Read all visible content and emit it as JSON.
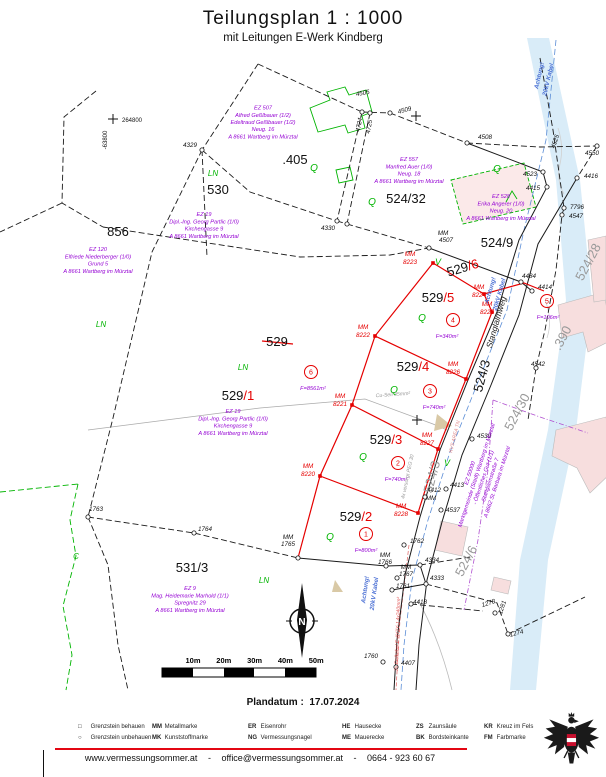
{
  "title": "Teilungsplan  1 : 1000",
  "subtitle": "mit Leitungen E-Werk Kindberg",
  "plandatum_label": "Plandatum :",
  "plandatum_value": "17.07.2024",
  "footer": {
    "website": "www.vermessungsommer.at",
    "sep": "-",
    "email": "office@vermessungsommer.at",
    "phone": "0664 - 923 60 67"
  },
  "legend": {
    "columns_x": [
      78,
      152,
      248,
      342,
      416,
      484
    ],
    "rows_y": [
      724,
      735
    ],
    "row1": [
      {
        "abbr": "□",
        "label": "Grenzstein behauen"
      },
      {
        "abbr": "MM",
        "label": "Metallmarke"
      },
      {
        "abbr": "ER",
        "label": "Eisenrohr"
      },
      {
        "abbr": "HE",
        "label": "Hausecke"
      },
      {
        "abbr": "ZS",
        "label": "Zaunsäule"
      },
      {
        "abbr": "KR",
        "label": "Kreuz im Fels"
      }
    ],
    "row2": [
      {
        "abbr": "○",
        "label": "Grenzstein unbehauen"
      },
      {
        "abbr": "MK",
        "label": "Kunststoffmarke"
      },
      {
        "abbr": "NG",
        "label": "Vermessungsnagel"
      },
      {
        "abbr": "ME",
        "label": "Mauerecke"
      },
      {
        "abbr": "BK",
        "label": "Bordsteinkante"
      },
      {
        "abbr": "FM",
        "label": "Farbmarke"
      }
    ]
  },
  "colors": {
    "new_boundary_red": "#e50000",
    "owner_purple": "#9400d3",
    "landuse_green": "#00b400",
    "cable_blue": "#4a6fd4",
    "stream_blue": "#d9ecf8",
    "building_pink": "#f7dede",
    "separator_red": "#e30613"
  },
  "map": {
    "scalebar": [
      "10m",
      "20m",
      "30m",
      "40m",
      "50m"
    ],
    "north": "N",
    "coordinate_cross": {
      "east": "264800",
      "north": "-63800"
    },
    "markers": [
      [
        202,
        150
      ],
      [
        362,
        112
      ],
      [
        370,
        113
      ],
      [
        390,
        113
      ],
      [
        467,
        143
      ],
      [
        543,
        172
      ],
      [
        547,
        187
      ],
      [
        597,
        146
      ],
      [
        577,
        178
      ],
      [
        564,
        208
      ],
      [
        562,
        215
      ],
      [
        536,
        368
      ],
      [
        337,
        221
      ],
      [
        347,
        224
      ],
      [
        429,
        248
      ],
      [
        521,
        282
      ],
      [
        532,
        291
      ],
      [
        472,
        439
      ],
      [
        446,
        489
      ],
      [
        425,
        497
      ],
      [
        441,
        510
      ],
      [
        404,
        545
      ],
      [
        420,
        565
      ],
      [
        426,
        584
      ],
      [
        386,
        566
      ],
      [
        397,
        578
      ],
      [
        392,
        590
      ],
      [
        411,
        604
      ],
      [
        495,
        613
      ],
      [
        508,
        634
      ],
      [
        396,
        667
      ],
      [
        383,
        662
      ],
      [
        88,
        517
      ],
      [
        194,
        533
      ],
      [
        298,
        558
      ]
    ],
    "red_markers": [
      [
        433,
        263
      ],
      [
        375,
        336
      ],
      [
        352,
        405
      ],
      [
        320,
        476
      ],
      [
        484,
        294
      ],
      [
        492,
        312
      ],
      [
        466,
        379
      ],
      [
        438,
        449
      ],
      [
        418,
        513
      ]
    ],
    "points": [
      {
        "t": "4329",
        "x": 190,
        "y": 147
      },
      {
        "t": "4505",
        "x": 363,
        "y": 95,
        "r": -10
      },
      {
        "t": "4509",
        "x": 405,
        "y": 112,
        "r": -15
      },
      {
        "t": "4724",
        "x": 361,
        "y": 125,
        "r": -80
      },
      {
        "t": "4725",
        "x": 371,
        "y": 127,
        "r": -80
      },
      {
        "t": "4330",
        "x": 328,
        "y": 230
      },
      {
        "t": "4508",
        "x": 485,
        "y": 139
      },
      {
        "t": "4523",
        "x": 530,
        "y": 176
      },
      {
        "t": "4415",
        "x": 533,
        "y": 190
      },
      {
        "t": "4550",
        "x": 592,
        "y": 155
      },
      {
        "t": "4416",
        "x": 591,
        "y": 178
      },
      {
        "t": "4525",
        "x": 557,
        "y": 142,
        "r": -72
      },
      {
        "t": "7796",
        "x": 577,
        "y": 209
      },
      {
        "t": "4547",
        "x": 576,
        "y": 218
      },
      {
        "t": "MM",
        "x": 443,
        "y": 235
      },
      {
        "t": "4507",
        "x": 446,
        "y": 242
      },
      {
        "t": "4484",
        "x": 529,
        "y": 278
      },
      {
        "t": "4414",
        "x": 545,
        "y": 289
      },
      {
        "t": "4542",
        "x": 538,
        "y": 366
      },
      {
        "t": "4539",
        "x": 484,
        "y": 438
      },
      {
        "t": "4413",
        "x": 457,
        "y": 487
      },
      {
        "t": "4412",
        "x": 434,
        "y": 492
      },
      {
        "t": "MM",
        "x": 431,
        "y": 500
      },
      {
        "t": "4537",
        "x": 453,
        "y": 512
      },
      {
        "t": "1762",
        "x": 417,
        "y": 543
      },
      {
        "t": "4334",
        "x": 432,
        "y": 562
      },
      {
        "t": "4333",
        "x": 437,
        "y": 580
      },
      {
        "t": "MM",
        "x": 385,
        "y": 557
      },
      {
        "t": "1766",
        "x": 385,
        "y": 564
      },
      {
        "t": "MM",
        "x": 406,
        "y": 569
      },
      {
        "t": "1767",
        "x": 406,
        "y": 576
      },
      {
        "t": "1761",
        "x": 403,
        "y": 588
      },
      {
        "t": "4418",
        "x": 420,
        "y": 604
      },
      {
        "t": "1278",
        "x": 489,
        "y": 605,
        "r": -18
      },
      {
        "t": "1281",
        "x": 504,
        "y": 608,
        "r": -72
      },
      {
        "t": "1274",
        "x": 517,
        "y": 635,
        "r": -15
      },
      {
        "t": "4407",
        "x": 408,
        "y": 665
      },
      {
        "t": "1760",
        "x": 371,
        "y": 658
      },
      {
        "t": "1763",
        "x": 96,
        "y": 511
      },
      {
        "t": "1764",
        "x": 205,
        "y": 531
      },
      {
        "t": "MM",
        "x": 288,
        "y": 539
      },
      {
        "t": "1765",
        "x": 288,
        "y": 546
      },
      {
        "t": "MM",
        "x": 410,
        "y": 256,
        "c": "r"
      },
      {
        "t": "8223",
        "x": 410,
        "y": 264,
        "c": "r"
      },
      {
        "t": "MM",
        "x": 363,
        "y": 329,
        "c": "r"
      },
      {
        "t": "8222",
        "x": 363,
        "y": 337,
        "c": "r"
      },
      {
        "t": "MM",
        "x": 340,
        "y": 398,
        "c": "r"
      },
      {
        "t": "8221",
        "x": 340,
        "y": 406,
        "c": "r"
      },
      {
        "t": "MM",
        "x": 308,
        "y": 468,
        "c": "r"
      },
      {
        "t": "8220",
        "x": 308,
        "y": 476,
        "c": "r"
      },
      {
        "t": "MM",
        "x": 479,
        "y": 289,
        "c": "r"
      },
      {
        "t": "8224",
        "x": 479,
        "y": 297,
        "c": "r"
      },
      {
        "t": "MM",
        "x": 487,
        "y": 306,
        "c": "r"
      },
      {
        "t": "8225",
        "x": 487,
        "y": 314,
        "c": "r"
      },
      {
        "t": "MM",
        "x": 453,
        "y": 366,
        "c": "r"
      },
      {
        "t": "8226",
        "x": 453,
        "y": 374,
        "c": "r"
      },
      {
        "t": "MM",
        "x": 427,
        "y": 437,
        "c": "r"
      },
      {
        "t": "8227",
        "x": 427,
        "y": 445,
        "c": "r"
      },
      {
        "t": "MM",
        "x": 401,
        "y": 508,
        "c": "r"
      },
      {
        "t": "8228",
        "x": 401,
        "y": 516,
        "c": "r"
      }
    ],
    "parcels": [
      {
        "t": "856",
        "x": 118,
        "y": 236,
        "s": 15
      },
      {
        "t": "530",
        "x": 218,
        "y": 194,
        "s": 15
      },
      {
        "t": ".405",
        "x": 295,
        "y": 164,
        "s": 13
      },
      {
        "t": "524/32",
        "x": 406,
        "y": 203,
        "s": 12
      },
      {
        "t": "524/9",
        "x": 497,
        "y": 247,
        "s": 13
      },
      {
        "t": "531/3",
        "x": 192,
        "y": 572,
        "s": 13
      },
      {
        "t": "529",
        "x": 277,
        "y": 346,
        "s": 12
      },
      {
        "t": "524/3",
        "x": 486,
        "y": 377,
        "s": 10,
        "r": -75
      },
      {
        "t": "524/3",
        "x": 436,
        "y": 478,
        "s": 6.5,
        "r": -75,
        "c": "gray"
      },
      {
        "t": "524/30",
        "x": 521,
        "y": 414,
        "s": 7,
        "r": -62,
        "c": "gray"
      },
      {
        "t": "524/28",
        "x": 592,
        "y": 264,
        "s": 7,
        "r": -62,
        "c": "gray"
      },
      {
        "t": "524/6",
        "x": 470,
        "y": 563,
        "s": 7,
        "r": -62,
        "c": "gray"
      },
      {
        "t": ".390",
        "x": 566,
        "y": 340,
        "s": 7,
        "r": -62,
        "c": "gray"
      }
    ],
    "new_parcels": [
      {
        "a": "529",
        "b": "/1",
        "x": 238,
        "y": 400,
        "s": 14
      },
      {
        "a": "529",
        "b": "/2",
        "x": 356,
        "y": 521,
        "s": 13
      },
      {
        "a": "529",
        "b": "/3",
        "x": 386,
        "y": 444,
        "s": 13
      },
      {
        "a": "529",
        "b": "/4",
        "x": 413,
        "y": 371,
        "s": 13
      },
      {
        "a": "529",
        "b": "/5",
        "x": 438,
        "y": 302,
        "s": 13
      },
      {
        "a": "529",
        "b": "/6",
        "x": 464,
        "y": 272,
        "s": 13,
        "r": -17
      }
    ],
    "owners": [
      {
        "x": 263,
        "y": 124,
        "lines": [
          "EZ 507",
          "Alfred Geßlbauer (1/2)",
          "Edeltraud Geßlbauer (1/2)",
          "Neug. 16",
          "A 8661 Wartberg im Mürztal"
        ]
      },
      {
        "x": 409,
        "y": 172,
        "lines": [
          "EZ 557",
          "Manfred Auer (1/0)",
          "Neug. 18",
          "A 8661 Wartberg im Mürztal"
        ]
      },
      {
        "x": 501,
        "y": 209,
        "lines": [
          "EZ 528",
          "Erika Angerer (1/0)",
          "Neug. 20",
          "A 8661 Wartberg im Mürztal"
        ]
      },
      {
        "x": 204,
        "y": 227,
        "lines": [
          "EZ 19",
          "Dipl.-Ing. Georg Partlic (1/0)",
          "Kirchengasse 9",
          "A 8661 Wartberg im Mürztal"
        ]
      },
      {
        "x": 98,
        "y": 262,
        "lines": [
          "EZ 120",
          "Elfriede Niederberger (1/0)",
          "Grund 5",
          "A 8661 Wartberg im Mürztal"
        ]
      },
      {
        "x": 233,
        "y": 424,
        "lines": [
          "EZ 19",
          "Dipl.-Ing. Georg Partlic (1/0)",
          "Kirchengasse 9",
          "A 8661 Wartberg im Mürztal"
        ]
      },
      {
        "x": 190,
        "y": 601,
        "lines": [
          "EZ 9",
          "Mag. Heidemarie Marhold (1/1)",
          "Spregnitz 29",
          "A 8661 Wartberg im Mürztal"
        ]
      },
      {
        "x": 485,
        "y": 478,
        "r": -72,
        "lines": [
          "EZ 50000",
          "Marktgemeinde (Stadt) Wartberg im Mürztal",
          "- Öffentliches Gut (1/1)",
          "Stanglalmstraße 7",
          "A 8662 St. Barbara im Mürztal"
        ]
      }
    ],
    "areas": [
      {
        "n": "1",
        "cx": 366,
        "cy": 534,
        "f": "F=800m²",
        "fx": 366,
        "fy": 552
      },
      {
        "n": "2",
        "cx": 398,
        "cy": 463,
        "f": "F=740m²",
        "fx": 396,
        "fy": 481
      },
      {
        "n": "3",
        "cx": 430,
        "cy": 391,
        "f": "F=740m²",
        "fx": 434,
        "fy": 409
      },
      {
        "n": "4",
        "cx": 453,
        "cy": 320,
        "f": "F=340m²",
        "fx": 447,
        "fy": 338
      },
      {
        "n": "5",
        "cx": 547,
        "cy": 301,
        "f": "F=106m²",
        "fx": 548,
        "fy": 319
      },
      {
        "n": "6",
        "cx": 311,
        "cy": 372,
        "f": "F=8561m²",
        "fx": 313,
        "fy": 390
      }
    ],
    "green_marks": [
      {
        "t": "LN",
        "x": 213,
        "y": 176,
        "s": 8
      },
      {
        "t": "LN",
        "x": 101,
        "y": 327,
        "s": 8
      },
      {
        "t": "LN",
        "x": 243,
        "y": 370,
        "s": 8
      },
      {
        "t": "LN",
        "x": 264,
        "y": 583,
        "s": 8
      },
      {
        "t": "Q",
        "x": 314,
        "y": 171,
        "s": 10
      },
      {
        "t": "Q",
        "x": 372,
        "y": 205,
        "s": 10
      },
      {
        "t": "Q",
        "x": 497,
        "y": 172,
        "s": 10
      },
      {
        "t": "Q",
        "x": 422,
        "y": 321,
        "s": 10
      },
      {
        "t": "Q",
        "x": 394,
        "y": 393,
        "s": 10
      },
      {
        "t": "Q",
        "x": 363,
        "y": 460,
        "s": 10
      },
      {
        "t": "Q",
        "x": 330,
        "y": 540,
        "s": 10
      },
      {
        "t": "V",
        "x": 438,
        "y": 265,
        "s": 9
      },
      {
        "t": "V",
        "x": 447,
        "y": 466,
        "s": 9
      },
      {
        "t": "C",
        "x": 76,
        "y": 559,
        "s": 8
      }
    ],
    "notes": [
      {
        "t": "Achtung!",
        "x": 492,
        "y": 291,
        "r": -74,
        "c": "blue"
      },
      {
        "t": "20kV Kabel",
        "x": 501,
        "y": 295,
        "r": -74,
        "c": "blue"
      },
      {
        "t": "Achtung!",
        "x": 367,
        "y": 590,
        "r": -82,
        "c": "blue"
      },
      {
        "t": "20kV Kabel",
        "x": 376,
        "y": 594,
        "r": -82,
        "c": "blue"
      },
      {
        "t": "Achtung!",
        "x": 541,
        "y": 76,
        "r": -77,
        "c": "blue"
      },
      {
        "t": "20kV Kabel",
        "x": 550,
        "y": 80,
        "r": -77,
        "c": "blue"
      },
      {
        "t": "2x Erdkabel E-AY2Y-J 4x240mm²",
        "x": 399,
        "y": 634,
        "r": -88,
        "c": "redc"
      },
      {
        "t": "Cu-Seil 35mm²",
        "x": 393,
        "y": 396,
        "r": -4,
        "c": "gray"
      },
      {
        "t": "4x versorgt PEG 30",
        "x": 409,
        "y": 477,
        "r": -78,
        "c": "gray"
      },
      {
        "t": "KVS AREA TN",
        "x": 456,
        "y": 437,
        "r": -76,
        "c": "salmon"
      },
      {
        "t": "Stanglalmweg",
        "x": 499,
        "y": 323,
        "r": -74,
        "c": "street"
      }
    ]
  }
}
